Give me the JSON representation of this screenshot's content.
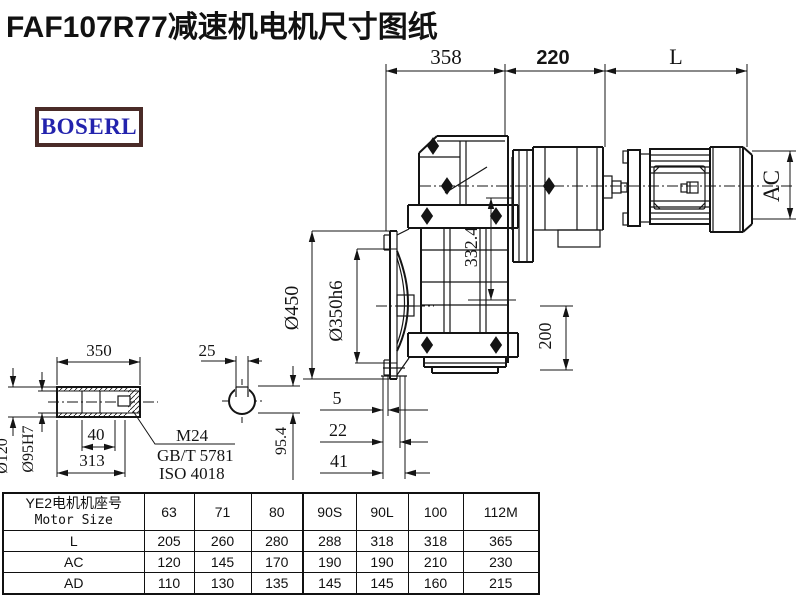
{
  "title": "FAF107R77减速机电机尺寸图纸",
  "logo": {
    "text": "BOSERL"
  },
  "colors": {
    "line": "#141414",
    "logo_text": "#2323ad",
    "logo_border": "#4a2b28",
    "background": "#ffffff"
  },
  "drawing": {
    "labels": {
      "dim_358": "358",
      "dim_220": "220",
      "dim_L": "L",
      "dim_AC": "AC",
      "dim_450": "Ø450",
      "dim_350h6": "Ø350h6",
      "dim_332_4": "332.4",
      "dim_200": "200",
      "dim_5": "5",
      "dim_22": "22",
      "dim_41": "41",
      "dim_95_4": "95.4",
      "dim_350": "350",
      "dim_25": "25",
      "dim_120": "Ø120",
      "dim_95h7": "Ø95H7",
      "dim_40": "40",
      "dim_313": "313",
      "note_m24": "M24",
      "note_gbt": "GB/T 5781",
      "note_iso": "ISO 4018"
    }
  },
  "table": {
    "header_cn": "YE2电机机座号",
    "header_en": "Motor Size",
    "columns": [
      "63",
      "71",
      "80",
      "90S",
      "90L",
      "100",
      "112M"
    ],
    "rows": [
      {
        "label": "L",
        "values": [
          "205",
          "260",
          "280",
          "288",
          "318",
          "318",
          "365"
        ]
      },
      {
        "label": "AC",
        "values": [
          "120",
          "145",
          "170",
          "190",
          "190",
          "210",
          "230"
        ]
      },
      {
        "label": "AD",
        "values": [
          "110",
          "130",
          "135",
          "145",
          "145",
          "160",
          "215"
        ]
      }
    ]
  }
}
